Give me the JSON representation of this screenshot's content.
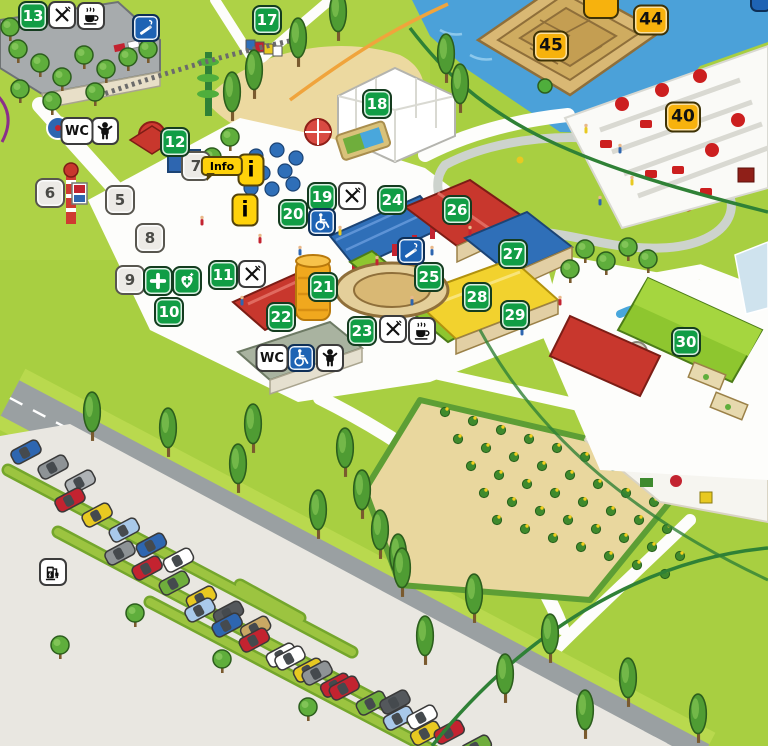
{
  "map": {
    "kind": "amusement-park-overview-map",
    "palette": {
      "grass": "#a8cf41",
      "path": "#ffffff",
      "road": "#9aa0a2",
      "water": "#4ba1d9",
      "green_badge": "#119d45",
      "gray_badge": "#eceae6",
      "yellow_badge": "#f7b20d",
      "blue_badge": "#1e63b4",
      "info_yellow": "#ffd20a"
    }
  },
  "markers": {
    "numbered": [
      {
        "label": "5",
        "style": "gray",
        "x": 120,
        "y": 200
      },
      {
        "label": "6",
        "style": "gray",
        "x": 50,
        "y": 193
      },
      {
        "label": "7",
        "style": "gray",
        "x": 196,
        "y": 166
      },
      {
        "label": "8",
        "style": "gray",
        "x": 150,
        "y": 238
      },
      {
        "label": "9",
        "style": "gray",
        "x": 130,
        "y": 280
      },
      {
        "label": "10",
        "style": "green",
        "x": 169,
        "y": 312
      },
      {
        "label": "11",
        "style": "green",
        "x": 223,
        "y": 275
      },
      {
        "label": "12",
        "style": "green",
        "x": 175,
        "y": 142
      },
      {
        "label": "13",
        "style": "green",
        "x": 33,
        "y": 16
      },
      {
        "label": "17",
        "style": "green",
        "x": 267,
        "y": 20
      },
      {
        "label": "18",
        "style": "green",
        "x": 377,
        "y": 104
      },
      {
        "label": "19",
        "style": "green",
        "x": 322,
        "y": 197
      },
      {
        "label": "20",
        "style": "green",
        "x": 293,
        "y": 214
      },
      {
        "label": "21",
        "style": "green",
        "x": 323,
        "y": 287
      },
      {
        "label": "22",
        "style": "green",
        "x": 281,
        "y": 317
      },
      {
        "label": "23",
        "style": "green",
        "x": 362,
        "y": 331
      },
      {
        "label": "24",
        "style": "green",
        "x": 392,
        "y": 200
      },
      {
        "label": "25",
        "style": "green",
        "x": 429,
        "y": 277
      },
      {
        "label": "26",
        "style": "green",
        "x": 457,
        "y": 210
      },
      {
        "label": "27",
        "style": "green",
        "x": 513,
        "y": 254
      },
      {
        "label": "28",
        "style": "green",
        "x": 477,
        "y": 297
      },
      {
        "label": "29",
        "style": "green",
        "x": 515,
        "y": 315
      },
      {
        "label": "30",
        "style": "green",
        "x": 686,
        "y": 342
      },
      {
        "label": "40",
        "style": "yellow",
        "x": 683,
        "y": 117
      },
      {
        "label": "44",
        "style": "yellow",
        "x": 651,
        "y": 20
      },
      {
        "label": "45",
        "style": "yellow",
        "x": 551,
        "y": 46
      }
    ],
    "icons": [
      {
        "name": "restaurant",
        "style": "white",
        "glyph": "forkknife",
        "x": 62,
        "y": 15
      },
      {
        "name": "restaurant",
        "style": "white",
        "glyph": "forkknife",
        "x": 352,
        "y": 196
      },
      {
        "name": "restaurant",
        "style": "white",
        "glyph": "forkknife",
        "x": 252,
        "y": 274
      },
      {
        "name": "restaurant",
        "style": "white",
        "glyph": "forkknife",
        "x": 393,
        "y": 329
      },
      {
        "name": "cafe",
        "style": "white",
        "glyph": "coffee",
        "x": 91,
        "y": 16
      },
      {
        "name": "cafe",
        "style": "white",
        "glyph": "coffee",
        "x": 422,
        "y": 331
      },
      {
        "name": "baby-care",
        "style": "white",
        "glyph": "baby",
        "x": 105,
        "y": 131
      },
      {
        "name": "baby-care",
        "style": "white",
        "glyph": "baby",
        "x": 330,
        "y": 358
      },
      {
        "name": "wheelchair",
        "style": "blue",
        "glyph": "wheelchair",
        "x": 322,
        "y": 222
      },
      {
        "name": "wheelchair",
        "style": "blue",
        "glyph": "wheelchair",
        "x": 301,
        "y": 358
      },
      {
        "name": "smoking-area",
        "style": "blue",
        "glyph": "smoking",
        "x": 146,
        "y": 28
      },
      {
        "name": "smoking-area",
        "style": "blue",
        "glyph": "smoking",
        "x": 411,
        "y": 251
      },
      {
        "name": "first-aid",
        "style": "green",
        "glyph": "plus",
        "x": 158,
        "y": 281
      },
      {
        "name": "defibrillator",
        "style": "green",
        "glyph": "heartcross",
        "x": 187,
        "y": 281
      },
      {
        "name": "ev-charging",
        "style": "white",
        "glyph": "ev",
        "x": 53,
        "y": 572
      }
    ],
    "text_badges": [
      {
        "name": "wc",
        "style": "white",
        "label": "WC",
        "x": 77,
        "y": 131,
        "w": 33
      },
      {
        "name": "wc",
        "style": "white",
        "label": "WC",
        "x": 272,
        "y": 358,
        "w": 33
      },
      {
        "name": "information",
        "style": "i",
        "label": "i",
        "x": 251,
        "y": 170
      },
      {
        "name": "information",
        "style": "i",
        "label": "i",
        "x": 245,
        "y": 210
      },
      {
        "name": "info-sign",
        "style": "bubble",
        "label": "Info",
        "x": 222,
        "y": 166
      }
    ],
    "partial_badges": [
      {
        "name": "truncated-yellow-badge",
        "style": "partY",
        "x": 601,
        "y": 8
      },
      {
        "name": "truncated-blue-badge",
        "style": "partB",
        "x": 761,
        "y": 5
      }
    ]
  }
}
